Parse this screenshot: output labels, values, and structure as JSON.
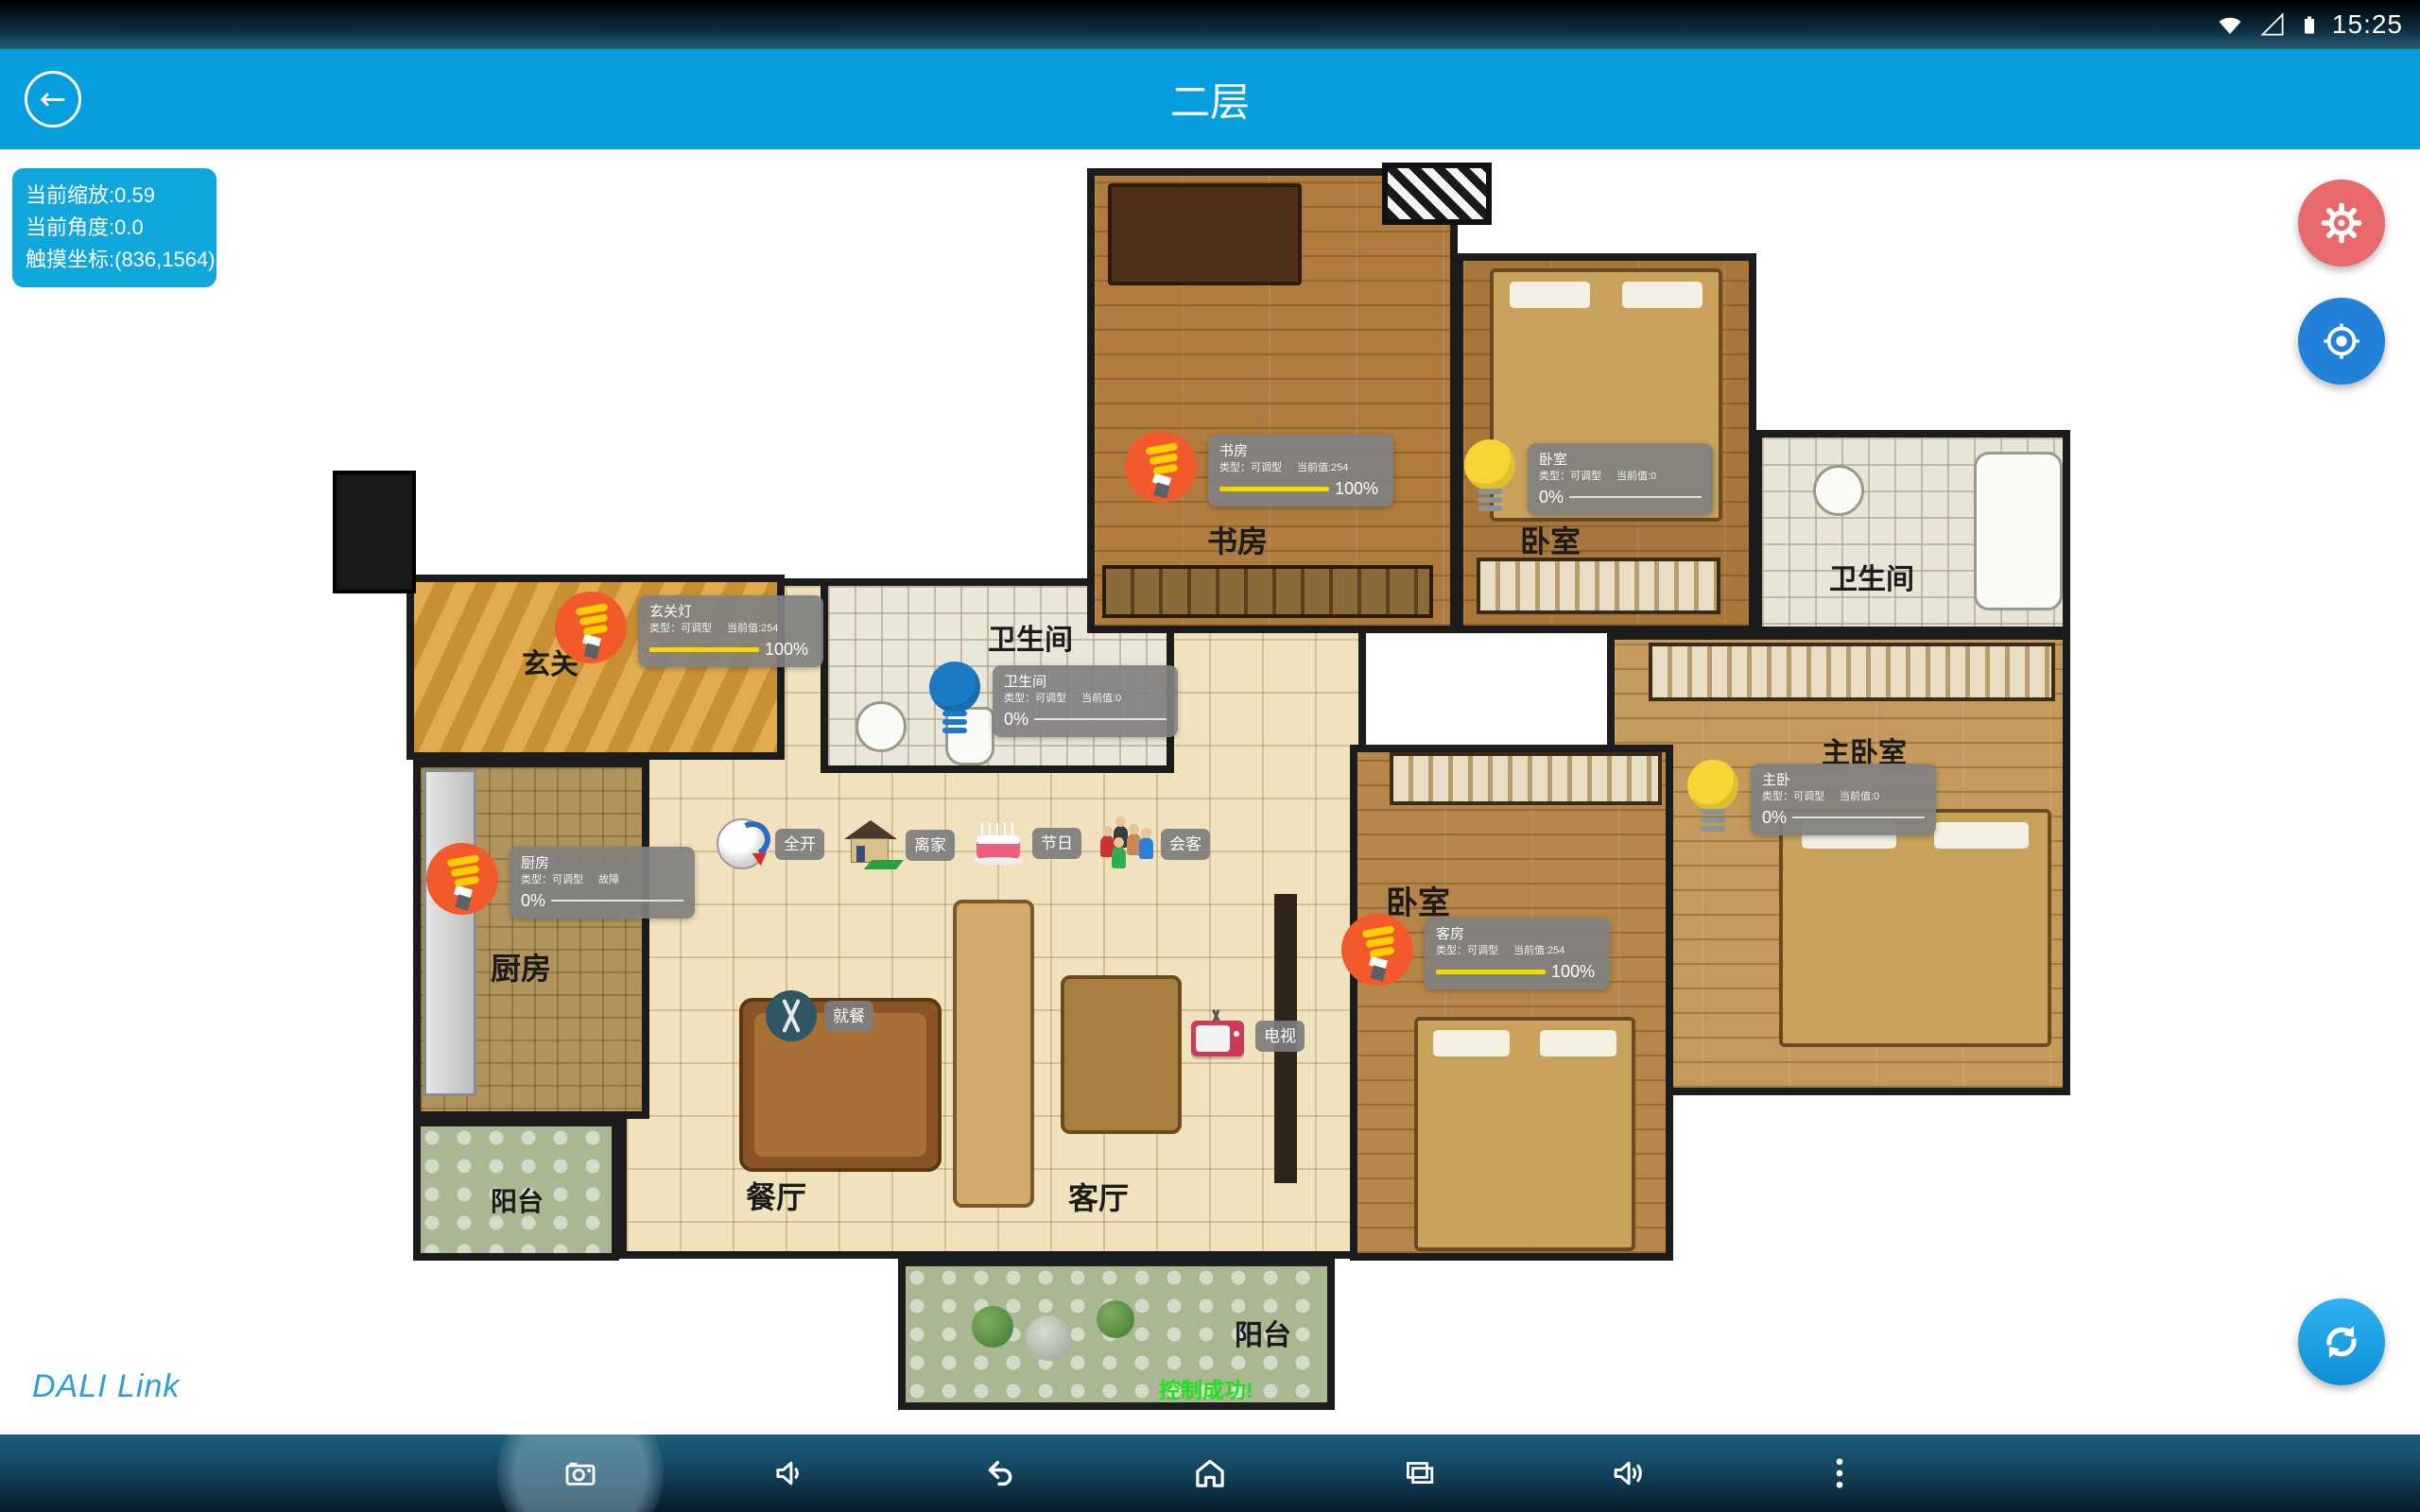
{
  "status_bar": {
    "time": "15:25",
    "icons": [
      "wifi-icon",
      "signal-strength-icon",
      "battery-icon"
    ]
  },
  "header": {
    "title": "二层",
    "back_icon": "back-arrow-icon"
  },
  "map_overlay": {
    "scale_text": "当前缩放:0.59",
    "angle_text": "当前角度:0.0",
    "touch_text": "触摸坐标:(836,1564)"
  },
  "fabs": {
    "settings_icon": "gear-icon",
    "locate_icon": "target-icon",
    "sync_icon": "sync-icon"
  },
  "floor_plan": {
    "rooms": [
      {
        "label": "玄关"
      },
      {
        "label": "书房"
      },
      {
        "label": "卧室"
      },
      {
        "label": "卫生间"
      },
      {
        "label": "卫生间"
      },
      {
        "label": "主卧室"
      },
      {
        "label": "卧室"
      },
      {
        "label": "厨房"
      },
      {
        "label": "餐厅"
      },
      {
        "label": "客厅"
      },
      {
        "label": "阳台"
      },
      {
        "label": "阳台"
      }
    ],
    "lights": [
      {
        "name": "玄关灯",
        "type_label": "类型：可调型",
        "status_label": "当前值:254",
        "percent": 100,
        "percent_label": "100%",
        "icon": "cfl-bulb-on-icon"
      },
      {
        "name": "书房",
        "type_label": "类型：可调型",
        "status_label": "当前值:254",
        "percent": 100,
        "percent_label": "100%",
        "icon": "cfl-bulb-on-icon"
      },
      {
        "name": "卧室",
        "type_label": "类型：可调型",
        "status_label": "当前值:0",
        "percent": 0,
        "percent_label": "0%",
        "icon": "bulb-off-icon"
      },
      {
        "name": "卫生间",
        "type_label": "类型：可调型",
        "status_label": "当前值:0",
        "percent": 0,
        "percent_label": "0%",
        "icon": "bulb-blue-icon"
      },
      {
        "name": "厨房",
        "type_label": "类型：可调型",
        "status_label": "故障",
        "percent": 0,
        "percent_label": "0%",
        "icon": "cfl-bulb-on-icon"
      },
      {
        "name": "客房",
        "type_label": "类型：可调型",
        "status_label": "当前值:254",
        "percent": 100,
        "percent_label": "100%",
        "icon": "cfl-bulb-on-icon"
      },
      {
        "name": "主卧",
        "type_label": "类型：可调型",
        "status_label": "当前值:0",
        "percent": 0,
        "percent_label": "0%",
        "icon": "bulb-off-icon"
      }
    ],
    "scene_buttons": [
      {
        "label": "全开",
        "icon": "dial-icon"
      },
      {
        "label": "离家",
        "icon": "house-icon"
      },
      {
        "label": "节日",
        "icon": "cake-icon"
      },
      {
        "label": "会客",
        "icon": "people-icon"
      }
    ],
    "zone_tags": [
      {
        "label": "就餐",
        "icon": "cutlery-icon"
      },
      {
        "label": "电视",
        "icon": "tv-icon"
      }
    ],
    "toast_text": "控制成功!"
  },
  "branding": {
    "logo_text": "DALI Link"
  },
  "nav_bar": {
    "icons": [
      "screenshot-camera-icon",
      "volume-down-icon",
      "back-icon",
      "home-icon",
      "recent-apps-icon",
      "volume-up-icon",
      "overflow-menu-icon"
    ]
  },
  "colors": {
    "header_blue": "#079edf",
    "overlay_blue": "#10a7dd",
    "fab_red": "#e8696b",
    "fab_blue": "#2281d9",
    "fab_sync_blue": "#189fe8",
    "bar_yellow": "#f5d800",
    "toast_green": "#1de21d",
    "brand_blue": "#2e9fd6"
  }
}
